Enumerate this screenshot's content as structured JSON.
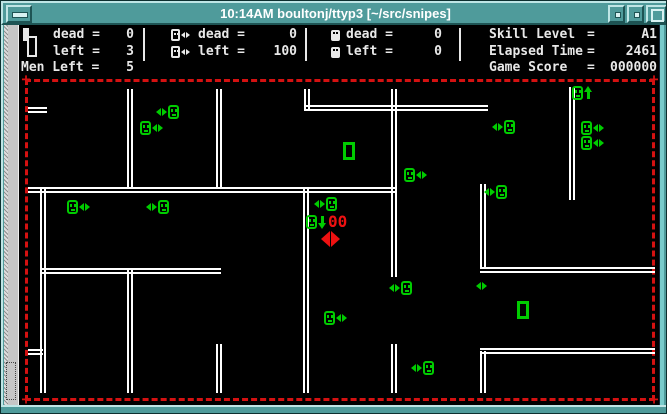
{
  "window": {
    "title": "10:14AM boultonj/ttyp3 [~/src/snipes]"
  },
  "status": {
    "group1": {
      "icon": "player-lives-icon",
      "dead_label": "dead =",
      "dead_value": "0",
      "left_label": "left =",
      "left_value": "3"
    },
    "group2": {
      "icon": "snipe-icon",
      "dead_label": "dead =",
      "dead_value": "0",
      "left_label": "left =",
      "left_value": "100"
    },
    "group3": {
      "icon": "hive-face-icon",
      "dead_label": "dead =",
      "dead_value": "0",
      "left_label": "left =",
      "left_value": "0"
    },
    "men_left_label": "Men Left =",
    "men_left_value": "5",
    "skill": {
      "label": "Skill Level",
      "eq": "=",
      "value": "A1"
    },
    "elapsed": {
      "label": "Elapsed Time",
      "eq": "=",
      "value": "2461"
    },
    "score": {
      "label": "Game Score",
      "eq": "=",
      "value": "000000"
    }
  },
  "player": {
    "counter": "00"
  },
  "colors": {
    "sprite_green": "#00cc00",
    "player_red": "#ee1111",
    "border_red": "#d41111",
    "wall_white": "#ffffff",
    "titlebar_teal": "#4f9b9b"
  },
  "maze": {
    "walls": [
      {
        "o": "h",
        "x": 27,
        "y": 106,
        "l": 19
      },
      {
        "o": "h",
        "x": 303,
        "y": 104,
        "l": 184
      },
      {
        "o": "h",
        "x": 27,
        "y": 186,
        "l": 367
      },
      {
        "o": "h",
        "x": 39,
        "y": 267,
        "l": 181
      },
      {
        "o": "h",
        "x": 479,
        "y": 266,
        "l": 175
      },
      {
        "o": "h",
        "x": 479,
        "y": 347,
        "l": 175
      },
      {
        "o": "h",
        "x": 27,
        "y": 348,
        "l": 15
      },
      {
        "o": "v",
        "x": 126,
        "y": 88,
        "l": 100
      },
      {
        "o": "v",
        "x": 215,
        "y": 88,
        "l": 100
      },
      {
        "o": "v",
        "x": 303,
        "y": 88,
        "l": 20
      },
      {
        "o": "v",
        "x": 390,
        "y": 88,
        "l": 188
      },
      {
        "o": "v",
        "x": 568,
        "y": 86,
        "l": 113
      },
      {
        "o": "v",
        "x": 302,
        "y": 186,
        "l": 206
      },
      {
        "o": "v",
        "x": 39,
        "y": 186,
        "l": 206
      },
      {
        "o": "v",
        "x": 126,
        "y": 267,
        "l": 125
      },
      {
        "o": "v",
        "x": 215,
        "y": 343,
        "l": 49
      },
      {
        "o": "v",
        "x": 390,
        "y": 343,
        "l": 49
      },
      {
        "o": "v",
        "x": 479,
        "y": 183,
        "l": 85
      },
      {
        "o": "v",
        "x": 479,
        "y": 350,
        "l": 42
      }
    ],
    "sprites": [
      {
        "t": "af",
        "x": 155,
        "y": 104
      },
      {
        "t": "fa",
        "x": 139,
        "y": 120
      },
      {
        "t": "fa",
        "x": 66,
        "y": 199
      },
      {
        "t": "af",
        "x": 145,
        "y": 199
      },
      {
        "t": "af",
        "x": 313,
        "y": 196
      },
      {
        "t": "hive",
        "x": 342,
        "y": 141
      },
      {
        "t": "fa",
        "x": 403,
        "y": 167
      },
      {
        "t": "af",
        "x": 491,
        "y": 119
      },
      {
        "t": "af",
        "x": 483,
        "y": 184
      },
      {
        "t": "fu",
        "x": 571,
        "y": 85
      },
      {
        "t": "fa",
        "x": 580,
        "y": 120
      },
      {
        "t": "fa",
        "x": 580,
        "y": 135
      },
      {
        "t": "af",
        "x": 388,
        "y": 280
      },
      {
        "t": "a",
        "x": 475,
        "y": 281
      },
      {
        "t": "hive",
        "x": 516,
        "y": 300
      },
      {
        "t": "af",
        "x": 410,
        "y": 360
      },
      {
        "t": "fa",
        "x": 323,
        "y": 310
      }
    ]
  }
}
